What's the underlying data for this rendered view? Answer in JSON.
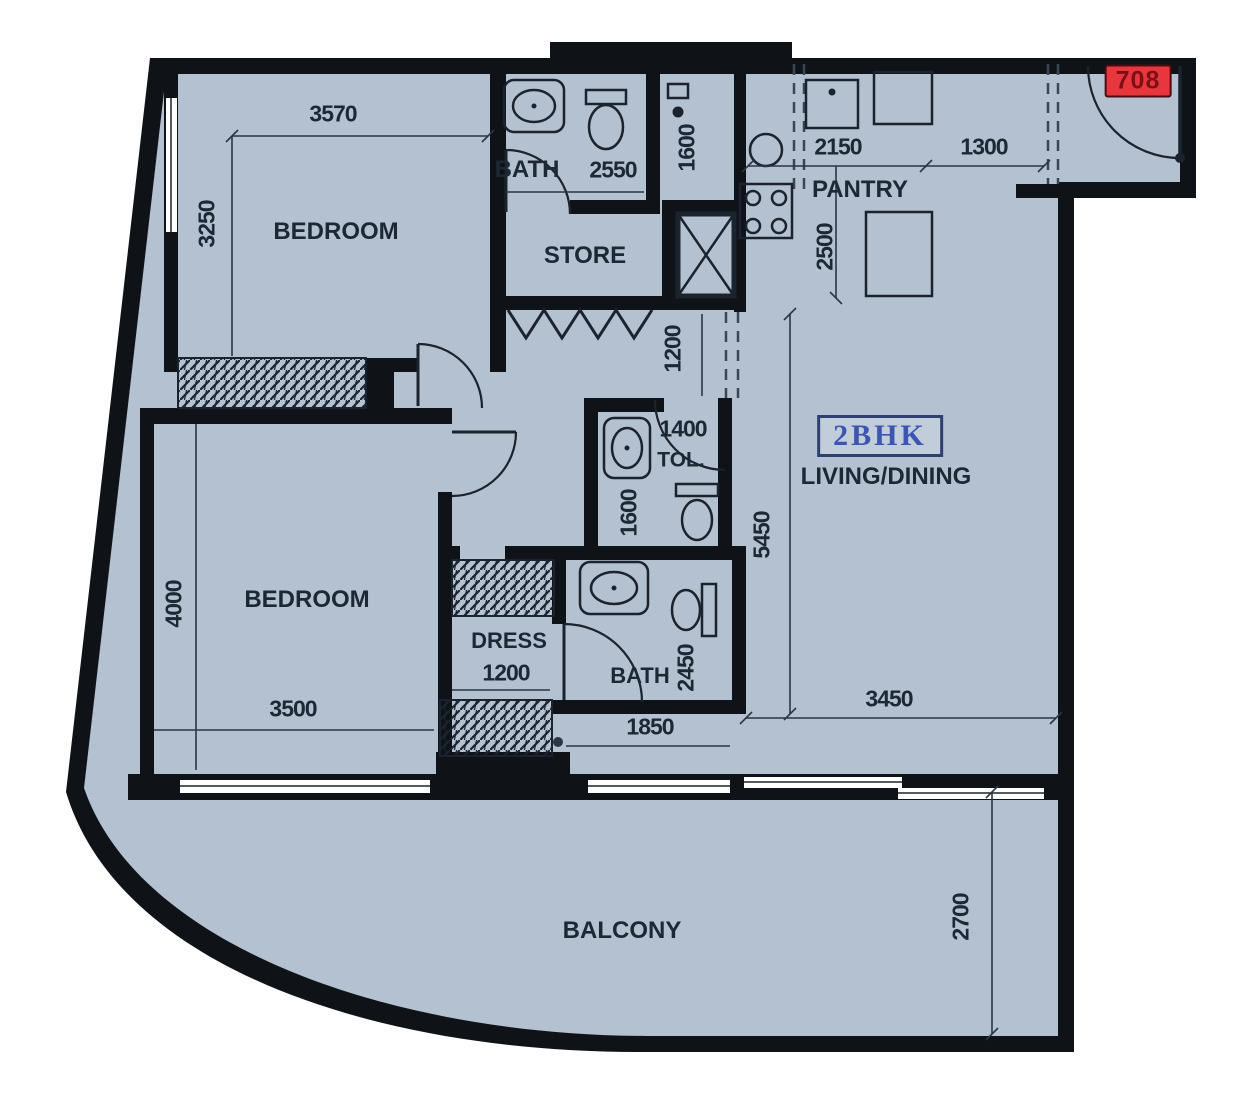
{
  "plan": {
    "unit_number": "708",
    "unit_type": "2BHK",
    "bedroom_top": {
      "label": "BEDROOM",
      "dim_width": "3570",
      "dim_depth": "3250"
    },
    "bath_top": {
      "label": "BATH",
      "dim_width": "2550",
      "dim_strip": "1600"
    },
    "store": {
      "label": "STORE"
    },
    "pantry": {
      "label": "PANTRY",
      "dim_left": "2150",
      "dim_right": "1300",
      "dim_depth": "2500"
    },
    "corridor": {
      "dim_width": "1200"
    },
    "toilet": {
      "label": "TOL.",
      "dim_width": "1400",
      "dim_depth": "1600"
    },
    "living_dining": {
      "label": "LIVING/DINING",
      "dim_depth": "5450",
      "dim_width": "3450"
    },
    "bedroom_bottom": {
      "label": "BEDROOM",
      "dim_depth": "4000",
      "dim_width": "3500"
    },
    "dress": {
      "label": "DRESS",
      "dim_width": "1200"
    },
    "bath_bottom": {
      "label": "BATH",
      "dim_width": "1850",
      "dim_depth": "2450"
    },
    "balcony": {
      "label": "BALCONY",
      "dim_depth": "2700"
    }
  },
  "colors": {
    "floor": "#b4c1d0",
    "wall": "#0f1318",
    "dim_text": "#1d2835",
    "unit_box_bg": "#e8363f",
    "unit_box_text": "#7c1016",
    "bhk_text": "#3c55b0",
    "bhk_border": "#2e4070"
  }
}
